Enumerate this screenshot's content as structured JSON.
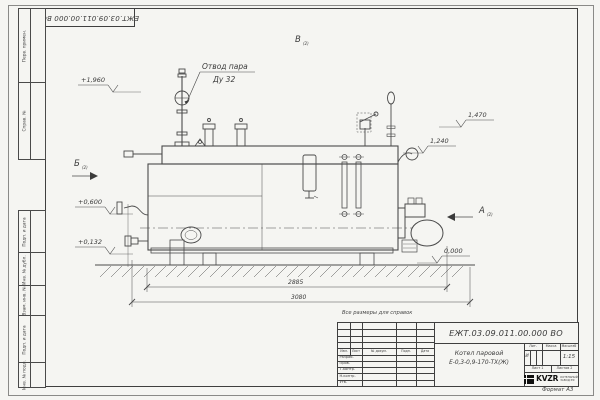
{
  "sheet": {
    "stamp_number": "ЕЖТ.03.09.011.00.000  ВО",
    "format_label": "Формат А3",
    "note": "Все размеры для справок",
    "side_labels": [
      "Перв. примен.",
      "Справ. №",
      "Подп. и дата",
      "Инв. № дубл.",
      "Взам. инв. №",
      "Подп. и дата",
      "Инв. № подл."
    ]
  },
  "drawing": {
    "callout": {
      "line1": "Отвод пара",
      "line2": "Ду 32"
    },
    "elevations": {
      "top": "+1,960",
      "front_upper": "+0,600",
      "front_lower": "+0,132",
      "rear_upper": "1,470",
      "rear_mid": "1,240",
      "ground": "0,000"
    },
    "views": {
      "a": "А",
      "b": "Б",
      "v": "В",
      "sheet_ref": "(2)"
    },
    "dimensions": {
      "length_inner": "2885",
      "length_overall": "3080"
    }
  },
  "title_block": {
    "doc_number": "ЕЖТ.03.09.011.00.000  ВО",
    "product_name_line1": "Котел паровой",
    "product_name_line2": "Е-0,3-0,9-170-ТХ(Ж)",
    "col_headers": {
      "izm": "Изм.",
      "list": "Лист",
      "doc": "№ докум.",
      "podp": "Подп.",
      "data": "Дата"
    },
    "rows": {
      "razrab": "Разраб.",
      "prov": "Пров.",
      "tkontr": "Т.контр.",
      "nkontr": "Н.контр.",
      "utv": "Утв."
    },
    "lit_header": "Лит.",
    "lit_value": "И",
    "mass_header": "Масса",
    "scale_header": "Масштаб",
    "scale_value": "1:15",
    "sheet_label": "Лист 1",
    "sheets_label": "Листов 2",
    "logo_text": "KVZR",
    "org_line1": "КОТЕЛЬНЫЙ",
    "org_line2": "ЗАВОД РФ"
  }
}
